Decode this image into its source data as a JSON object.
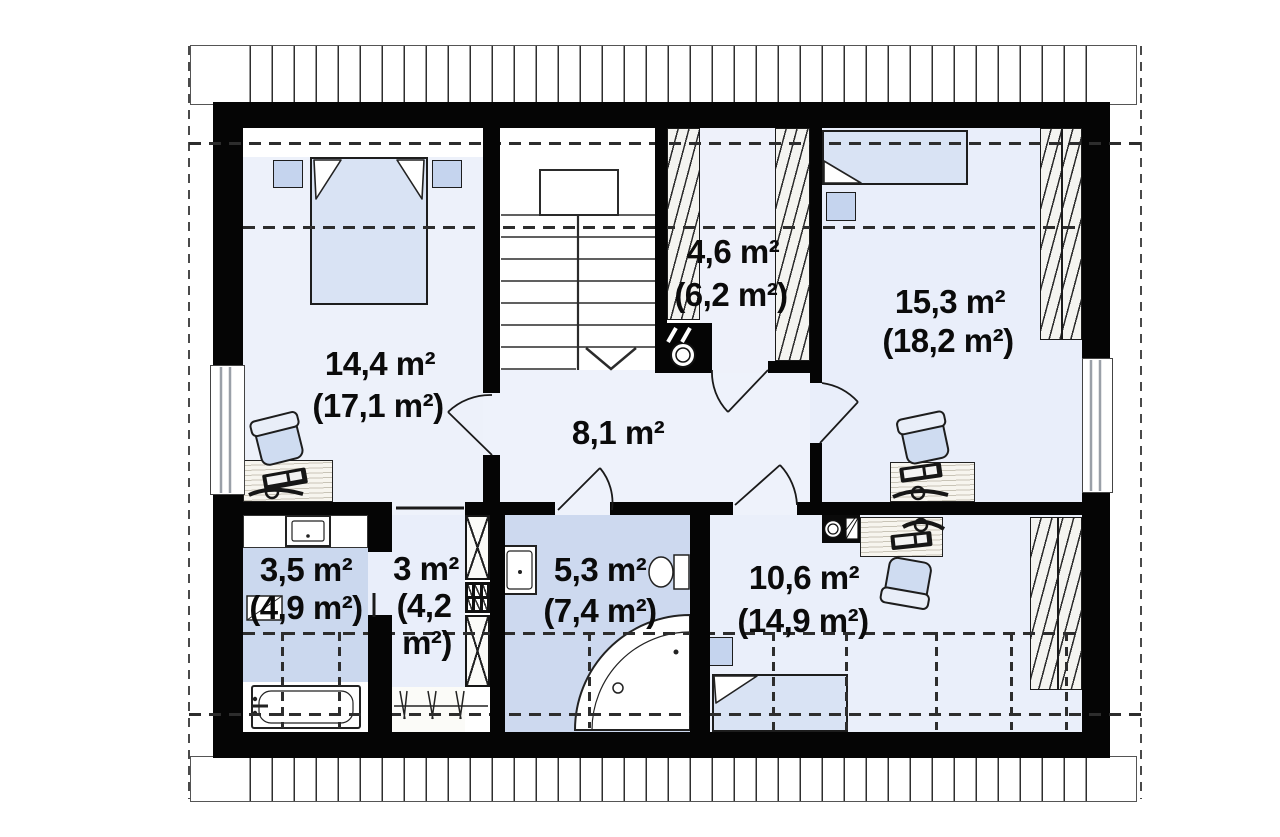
{
  "rooms": {
    "bedroom1": {
      "area": "14,4 m²",
      "area_gross": "(17,1 m²)"
    },
    "wardrobe": {
      "area": "4,6 m²",
      "area_gross": "(6,2 m²)"
    },
    "bedroom2": {
      "area": "15,3 m²",
      "area_gross": "(18,2 m²)"
    },
    "hallway": {
      "area": "8,1 m²"
    },
    "bathroom1": {
      "area": "3,5 m²",
      "area_gross": "(4,9 m²)"
    },
    "closet": {
      "area": "3 m²",
      "area_gross_line1": "(4,2",
      "area_gross_line2": "m²)"
    },
    "bathroom2": {
      "area": "5,3 m²",
      "area_gross": "(7,4 m²)"
    },
    "bedroom3": {
      "area": "10,6 m²",
      "area_gross": "(14,9 m²)"
    }
  },
  "colors": {
    "wall": "#050505",
    "floor_light": "#ecf1fa",
    "floor_medium": "#ccd9ee",
    "furniture_blue": "#d9e3f4",
    "hatch_bg": "#f4f4f0"
  }
}
